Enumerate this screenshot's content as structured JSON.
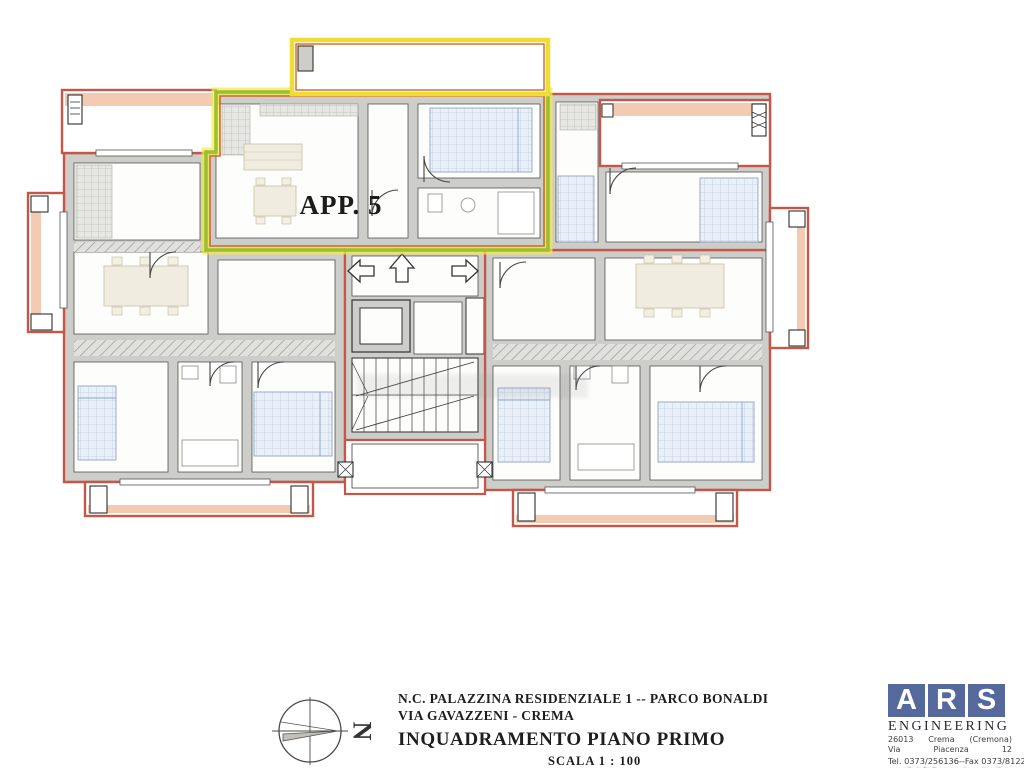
{
  "plan": {
    "apartment_label": "APP. 5"
  },
  "compass": {
    "north_label": "N"
  },
  "title_block": {
    "project_line1": "N.C. PALAZZINA RESIDENZIALE 1 -- PARCO BONALDI",
    "project_line2": "VIA GAVAZZENI - CREMA",
    "drawing_title": "INQUADRAMENTO PIANO PRIMO",
    "scale_label": "SCALA 1 : 100"
  },
  "logo": {
    "letters": [
      "A",
      "R",
      "S"
    ],
    "company": "ENGINEERING",
    "address_line1": [
      "26013",
      "Crema",
      "(Cremona)"
    ],
    "address_line2": [
      "Via",
      "Piacenza",
      "12"
    ],
    "phone_fax": "Tel. 0373/256136--Fax 0373/81221",
    "email_line": "e-mail: info@arsengineering.it  www.arsengineering.it"
  },
  "colors": {
    "exterior_wall_red": "#c4574a",
    "balcony_fill_salmon": "#f2cbb2",
    "interior_wall_gray": "#cdcdca",
    "highlight_outline_green": "#9bbf2e",
    "highlight_glow_yellow": "#f4e84a",
    "balcony_border_yellow": "#f0dc35",
    "accent_orange": "#cc6a2d",
    "logo_blue": "#56699c"
  }
}
